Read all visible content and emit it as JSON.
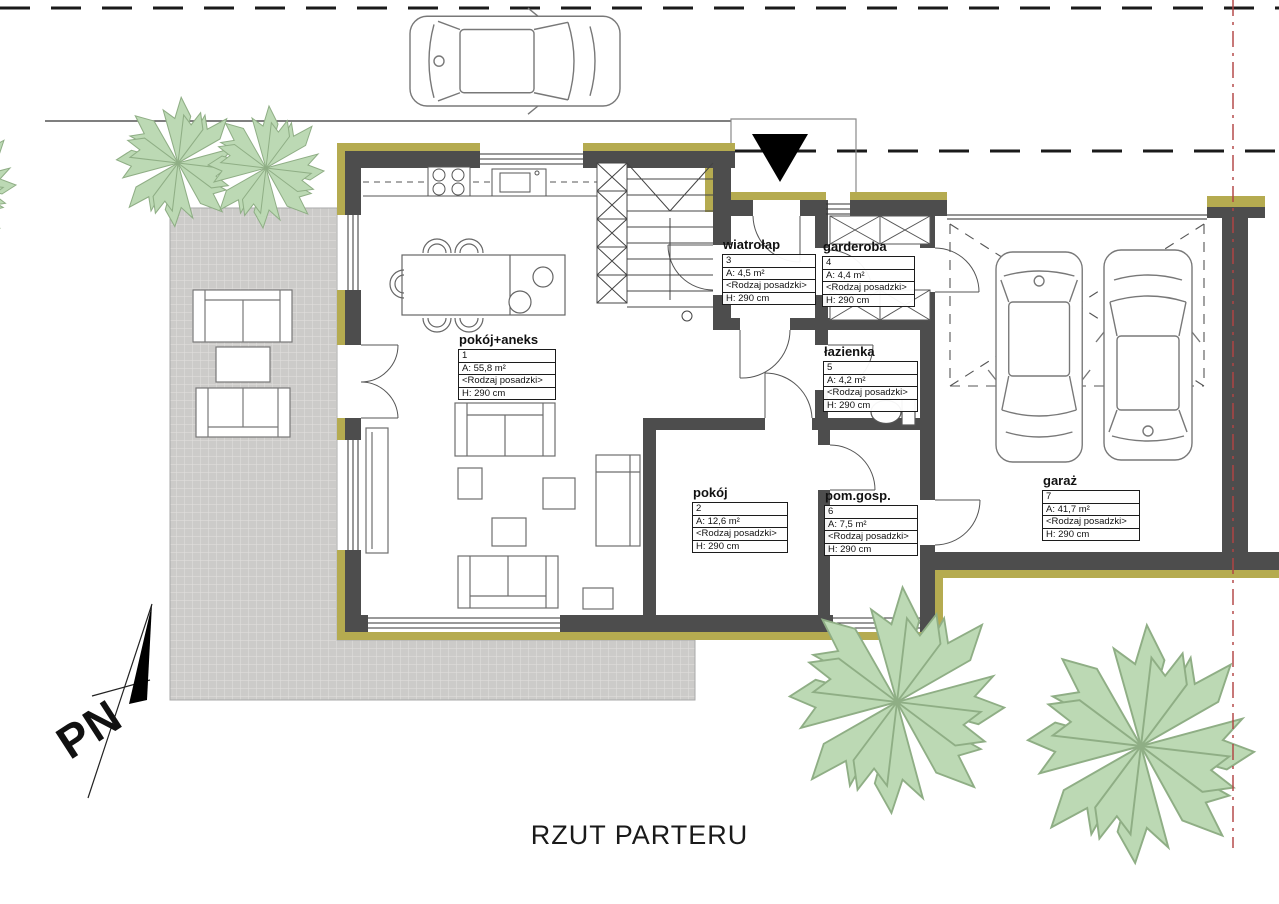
{
  "title": "RZUT PARTERU",
  "north": {
    "label": "PN"
  },
  "rooms": [
    {
      "name": "pokój+aneks",
      "number": "1",
      "area": "A: 55,8 m²",
      "floor": "<Rodzaj posadzki>",
      "height": "H: 290 cm"
    },
    {
      "name": "pokój",
      "number": "2",
      "area": "A: 12,6 m²",
      "floor": "<Rodzaj posadzki>",
      "height": "H: 290 cm"
    },
    {
      "name": "wiatrołap",
      "number": "3",
      "area": "A: 4,5 m²",
      "floor": "<Rodzaj posadzki>",
      "height": "H: 290 cm"
    },
    {
      "name": "garderoba",
      "number": "4",
      "area": "A: 4,4 m²",
      "floor": "<Rodzaj posadzki>",
      "height": "H: 290 cm"
    },
    {
      "name": "łazienka",
      "number": "5",
      "area": "A: 4,2 m²",
      "floor": "<Rodzaj posadzki>",
      "height": "H: 290 cm"
    },
    {
      "name": "pom.gosp.",
      "number": "6",
      "area": "A: 7,5 m²",
      "floor": "<Rodzaj posadzki>",
      "height": "H: 290 cm"
    },
    {
      "name": "garaż",
      "number": "7",
      "area": "A: 41,7 m²",
      "floor": "<Rodzaj posadzki>",
      "height": "H: 290 cm"
    }
  ],
  "colors": {
    "wall": "#4d4d4d",
    "insulation": "#b5ab50",
    "tree_fill": "#bcd9b4",
    "tree_stroke": "#8fae85",
    "terrace": "#cccbc9",
    "boundary_line": "#b24444",
    "line": "#1a1a1a"
  }
}
